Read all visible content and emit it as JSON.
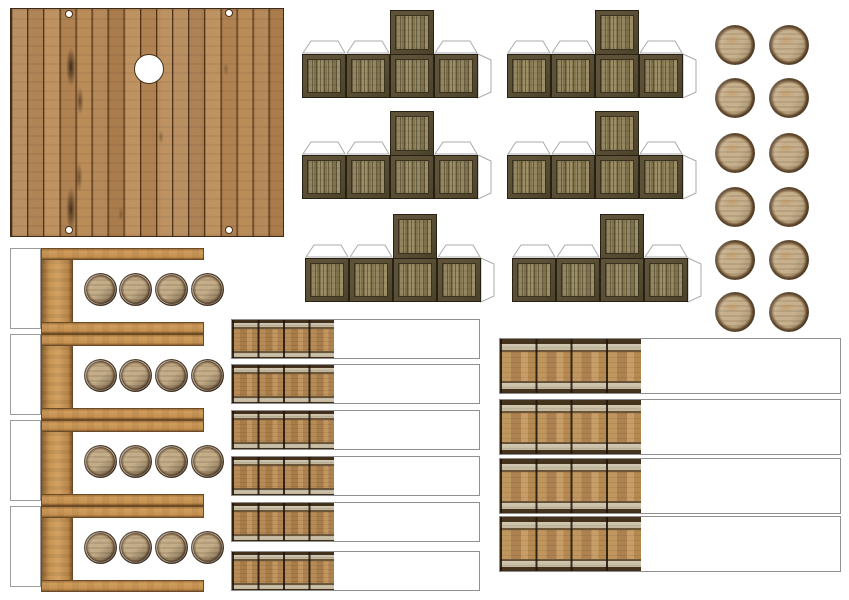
{
  "canvas": {
    "width": 849,
    "height": 600,
    "background": "#ffffff"
  },
  "sheet_type": "papercraft-cutout-sheet",
  "palette": {
    "deck_wood": "#b5895a",
    "deck_line": "#3c2917",
    "crate_frame": "#544a31",
    "crate_panel": "#8e8058",
    "barrel_rim": "#55412a",
    "barrel_face": "#c6b08d",
    "shelf_wood": "#c89553",
    "wrap_wood": "#b78b55",
    "wrap_band": "#d1c7b1",
    "tab_outline": "#ababab",
    "cut_outline": "#8f8f8f"
  },
  "sections": {
    "deck_panel": {
      "type": "wood-plank-deck",
      "x": 10,
      "y": 8,
      "width": 274,
      "height": 229,
      "plank_count": 17,
      "corner_hole_diameter": 8,
      "corner_holes": [
        {
          "cx": 58,
          "cy": 5
        },
        {
          "cx": 218,
          "cy": 4
        },
        {
          "cx": 58,
          "cy": 221
        },
        {
          "cx": 218,
          "cy": 221
        }
      ],
      "center_hole": {
        "cx": 138,
        "cy": 60,
        "diameter": 30
      }
    },
    "crate_nets": {
      "type": "crate-cube-net",
      "count": 6,
      "face_size": 44,
      "faces_per_row": 4,
      "top_face_column": 3,
      "tab_height": 14,
      "nets": [
        {
          "x": 302,
          "y": 10
        },
        {
          "x": 507,
          "y": 10
        },
        {
          "x": 302,
          "y": 111
        },
        {
          "x": 507,
          "y": 111
        },
        {
          "x": 305,
          "y": 214
        },
        {
          "x": 512,
          "y": 214
        }
      ]
    },
    "barrel_lids": {
      "type": "barrel-lid",
      "count": 12,
      "diameter": 40,
      "columns_cx": [
        735,
        789
      ],
      "rows_cy": [
        45,
        98,
        153,
        207,
        260,
        312
      ]
    },
    "shelf_units": {
      "type": "barrel-shelf-side",
      "count": 4,
      "x": 10,
      "width": 215,
      "unit_height": 86,
      "unit_ys": [
        248,
        334,
        420,
        506
      ],
      "tab": {
        "x": 0,
        "width": 31,
        "height": 81
      },
      "post": {
        "x": 31,
        "width": 32,
        "height": 80
      },
      "bar": {
        "x": 31,
        "width": 163,
        "height": 12
      },
      "barrels": {
        "count": 4,
        "diameter": 33,
        "cy": 41,
        "cxs": [
          90,
          125,
          161,
          197
        ]
      }
    },
    "wrap_strips_small": {
      "type": "barrel-wrap-strip",
      "count": 6,
      "x": 231,
      "width": 249,
      "height": 40,
      "wood_width": 102,
      "ys": [
        319,
        364,
        410,
        456,
        502,
        551
      ]
    },
    "wrap_strips_large": {
      "type": "crate-wrap-strip",
      "count": 4,
      "x": 499,
      "width": 342,
      "height": 56,
      "wood_width": 141,
      "ys": [
        338,
        399,
        458,
        516
      ]
    }
  }
}
